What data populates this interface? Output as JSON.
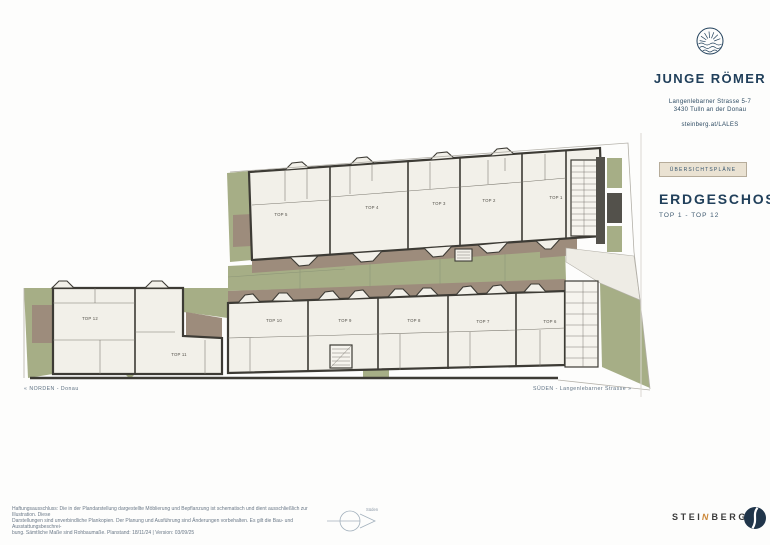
{
  "brand": {
    "name": "JUNGE RÖMER",
    "address_line1": "Langenlebarner Strasse 5-7",
    "address_line2": "3430 Tulln an der Donau",
    "website": "steinberg.at/LALES"
  },
  "sidebar": {
    "chip_label": "ÜBERSICHTSPLÄNE",
    "title": "ERDGESCHOSS",
    "subtitle": "TOP 1 - TOP 12"
  },
  "plan": {
    "direction_north": "« NORDEN - Donau",
    "direction_south": "SÜDEN - Langenlebarner Strasse »",
    "compass_label": "Süden",
    "upper_units": [
      "TOP 5",
      "TOP 4",
      "TOP 3",
      "TOP 2",
      "TOP 1"
    ],
    "lower_units": [
      "TOP 12",
      "TOP 11",
      "TOP 10",
      "TOP 9",
      "TOP 8",
      "TOP 7",
      "TOP 6"
    ],
    "colors": {
      "garden": "#a6ae86",
      "terrace": "#9d8c7c",
      "wall": "#3d3b35",
      "interior": "#f2f0e9",
      "neighbor": "#53514b",
      "accent_navy": "#21405b",
      "accent_orange": "#cd8a3c"
    }
  },
  "footer": {
    "disclaimer_line1": "Haftungsausschluss: Die in der Plandarstellung dargestellte Möblierung und Bepflanzung ist schematisch und dient ausschließlich zur Illustration. Diese",
    "disclaimer_line2": "Darstellungen sind unverbindliche Plankopien. Der Planung und Ausführung sind Änderungen vorbehalten. Es gilt die Bau- und Ausstattungsbeschrei-",
    "disclaimer_line3": "bung. Sämtliche Maße sind Rohbaumaße. Planstand: 18/11/24  |  Version: 03/09/25",
    "publisher_part1": "STEI",
    "publisher_accent": "N",
    "publisher_part2": "BERG"
  }
}
